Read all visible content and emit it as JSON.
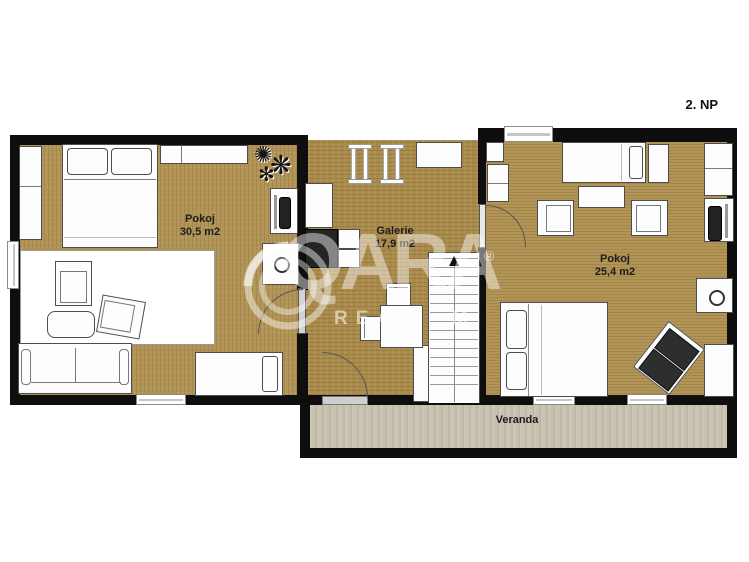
{
  "floor_label": "2. NP",
  "rooms": [
    {
      "id": "pokoj-left",
      "name": "Pokoj",
      "area": "30,5 m2"
    },
    {
      "id": "galerie",
      "name": "Galerie",
      "area": "17,9 m2"
    },
    {
      "id": "pokoj-right",
      "name": "Pokoj",
      "area": "25,4 m2"
    },
    {
      "id": "veranda",
      "name": "Veranda",
      "area": ""
    }
  ],
  "watermark": {
    "brand": "QARA",
    "registered": "®",
    "subtitle_left": "REAL",
    "subtitle_right": "M"
  },
  "colors": {
    "wall": "#0e0e0e",
    "wood_floor": "#b29456",
    "galerie_floor": "#aa8b4b",
    "veranda_floor": "#c9c2b1",
    "furniture_fill": "#fdfdfd",
    "furniture_outline": "#4d4d4d",
    "dark_furniture": "#242424"
  }
}
